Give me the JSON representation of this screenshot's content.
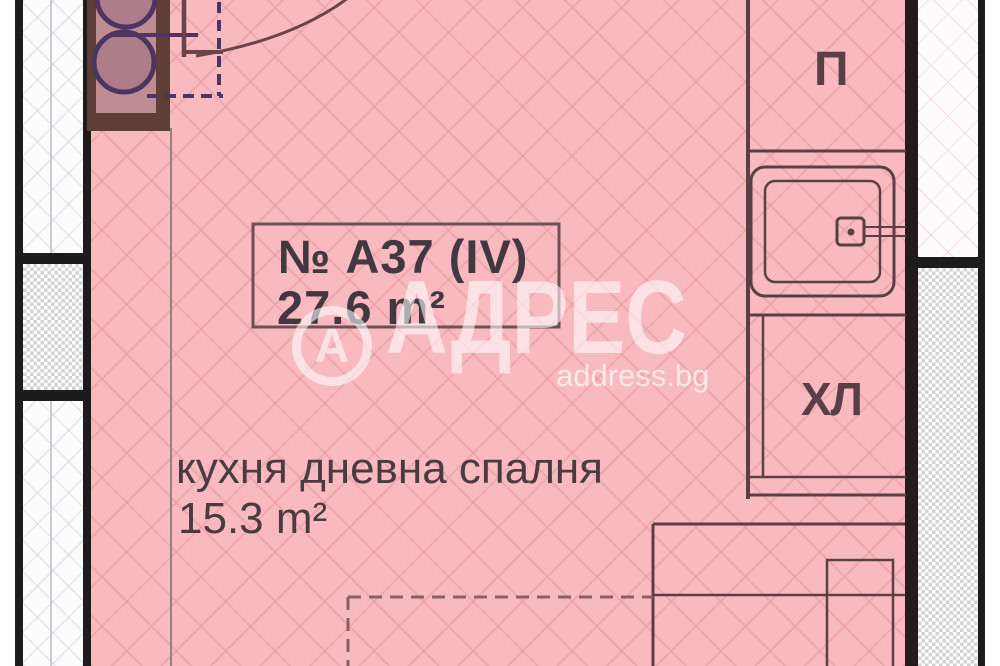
{
  "plan": {
    "unit_box": {
      "number": "№ А37 (IV)",
      "area": "27.6 m²"
    },
    "room": {
      "label": "кухня дневна спалня",
      "area": "15.3 m²"
    },
    "labels": {
      "anteroom": "П",
      "fridge": "ХЛ"
    }
  },
  "watermark": {
    "logo_letter": "А",
    "brand": "АДРЕС",
    "domain": "address.bg"
  },
  "colors": {
    "room_fill": "#f8babe",
    "hatch_line": "#de808c",
    "wall_black": "#1c1c1c",
    "wall_dark_brown": "#241b1d",
    "line_brown": "#5a4045",
    "purple_accent": "#4e3560",
    "cabinet_brown": "#5f3e36",
    "cabinet_inner": "#bd8d92",
    "text_dark": "#423940",
    "watermark_white": "#ffffff"
  }
}
